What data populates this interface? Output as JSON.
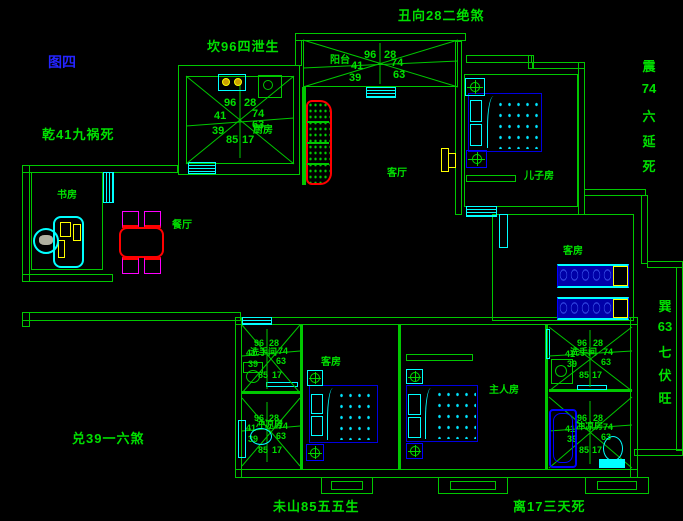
{
  "title": {
    "figure": "图四"
  },
  "annotations": {
    "north": "坎96四泄生",
    "facing": "丑向28二绝煞",
    "northwest": "乾41九祸死",
    "west": "兑39一六煞",
    "mountain": "未山85五五生",
    "south": "离17三天死",
    "east_vertical": [
      "震",
      "74",
      "六",
      "延",
      "死"
    ],
    "southeast_vertical": [
      "巽",
      "63",
      "七",
      "伏",
      "旺"
    ]
  },
  "compass": {
    "tl": "96",
    "tr": "28",
    "l": "41",
    "r": "74",
    "bl": "39",
    "br": "63",
    "b1": "85",
    "b2": "17"
  },
  "rooms": {
    "kitchen": "厨房",
    "balcony": "阳台",
    "living": "客厅",
    "son": "儿子房",
    "guest_right": "客房",
    "study": "书房",
    "dining": "餐厅",
    "washroom_left": "洗手间",
    "shower_left": "冲凉房",
    "guest_bottom": "客房",
    "master": "主人房",
    "washroom_right": "洗手间",
    "shower_right": "冲凉房"
  },
  "colors": {
    "wall_green": "#00c800",
    "text_green": "#00e000",
    "window_cyan": "#00ffff",
    "furniture_blue": "#0000e0",
    "accent_yellow": "#ffff00",
    "accent_red": "#ff0000",
    "accent_magenta": "#ff00ff",
    "figure_label_blue": "#2424ff"
  }
}
